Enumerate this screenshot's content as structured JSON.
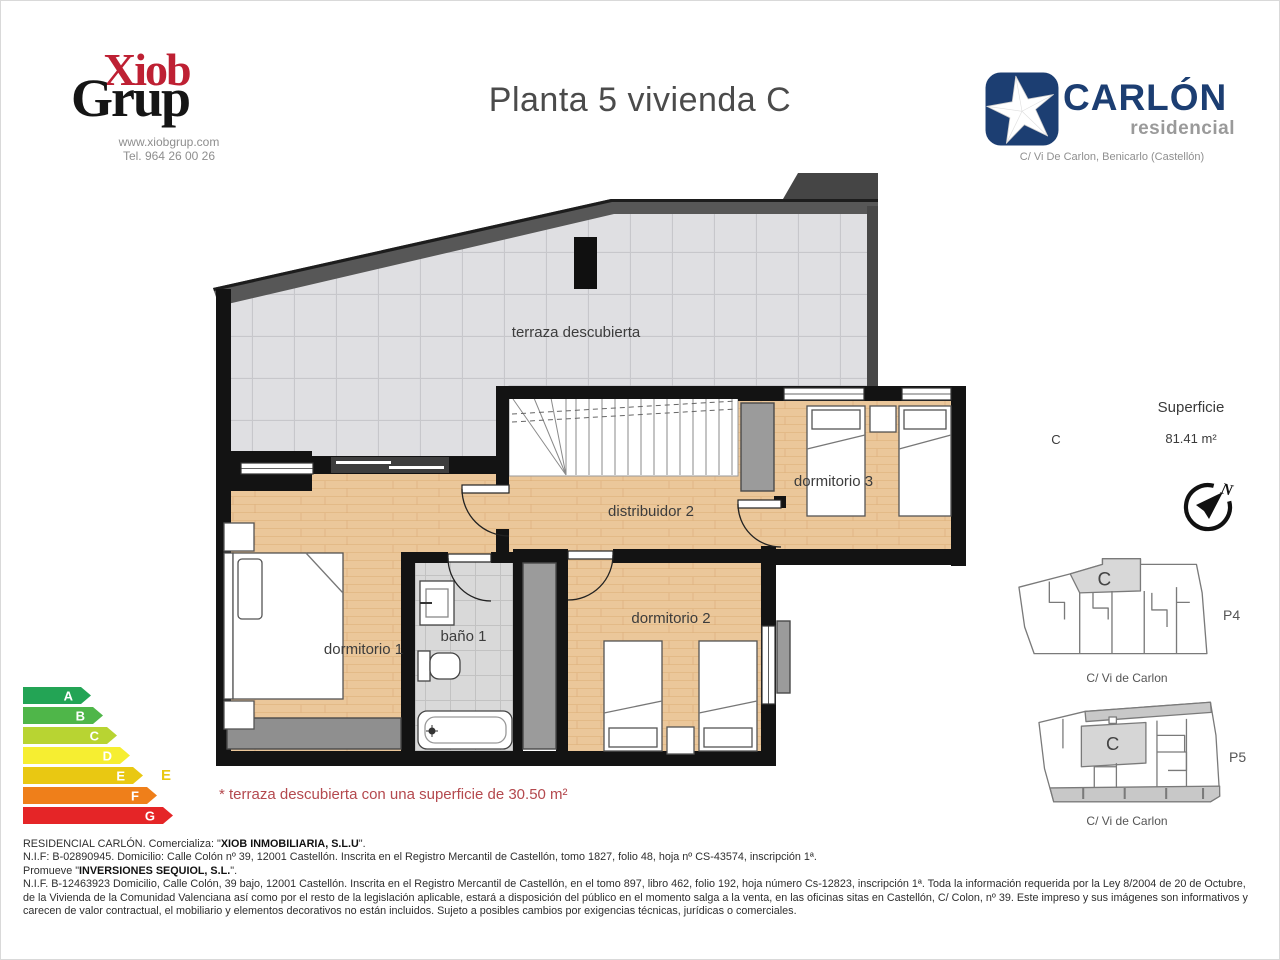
{
  "header": {
    "brand": {
      "top": "Xiob",
      "bottom": "Grup",
      "website": "www.xiobgrup.com",
      "phone": "Tel. 964 26 00 26"
    },
    "title": "Planta 5 vivienda C",
    "developer": {
      "name": "CARLÓN",
      "tagline": "residencial",
      "address": "C/ Vi De Carlon, Benicarlo (Castellón)"
    }
  },
  "plan": {
    "labels": {
      "terrace": "terraza descubierta",
      "hall": "distribuidor 2",
      "bedroom3": "dormitorio 3",
      "bedroom1": "dormitorio 1",
      "bath1": "baño 1",
      "bedroom2": "dormitorio 2"
    }
  },
  "surface": {
    "heading": "Superficie",
    "unit_label": "C",
    "area": "81.41 m²"
  },
  "compass": {
    "north": "N"
  },
  "locators": [
    {
      "unit": "C",
      "plate": "P4",
      "street": "C/ Vi de Carlon"
    },
    {
      "unit": "C",
      "plate": "P5",
      "street": "C/ Vi de Carlon"
    }
  ],
  "energy_rating": {
    "scale": [
      {
        "letter": "A",
        "color": "#23a455",
        "width": 58
      },
      {
        "letter": "B",
        "color": "#4fb649",
        "width": 70
      },
      {
        "letter": "C",
        "color": "#b8d432",
        "width": 84
      },
      {
        "letter": "D",
        "color": "#f6ee31",
        "width": 97
      },
      {
        "letter": "E",
        "color": "#e9c812",
        "width": 110
      },
      {
        "letter": "F",
        "color": "#ef7f1a",
        "width": 124
      },
      {
        "letter": "G",
        "color": "#e52527",
        "width": 140
      }
    ],
    "current": "E",
    "current_color": "#e9c812"
  },
  "note": "* terraza descubierta con una superficie de 30.50 m²",
  "footer": {
    "line1_pre": "RESIDENCIAL CARLÓN. Comercializa: \"",
    "line1_bold": "XIOB INMOBILIARIA, S.L.U",
    "line1_post": "\".",
    "line2": "N.I.F: B-02890945. Domicilio: Calle Colón nº 39, 12001 Castellón. Inscrita en el Registro Mercantil de Castellón, tomo 1827, folio 48, hoja nº CS-43574, inscripción 1ª.",
    "line3_pre": "Promueve \"",
    "line3_bold": "INVERSIONES SEQUIOL, S.L.",
    "line3_post": "\".",
    "paragraph": "N.I.F. B-12463923 Domicilio, Calle Colón, 39 bajo, 12001 Castellón. Inscrita en el Registro Mercantil de Castellón, en el tomo 897, libro 462, folio 192, hoja número Cs-12823, inscripción 1ª. Toda la información requerida por la Ley 8/2004 de 20 de Octubre, de la Vivienda de la Comunidad Valenciana así como por el resto de la legislación aplicable, estará a disposición del público en el momento salga a la venta, en las oficinas sitas en Castellón, C/ Colon, nº 39. Este impreso y sus imágenes son informativos y carecen de valor contractual, el mobiliario y elementos decorativos no están incluidos. Sujeto a posibles cambios por exigencias técnicas, jurídicas o comerciales."
  }
}
